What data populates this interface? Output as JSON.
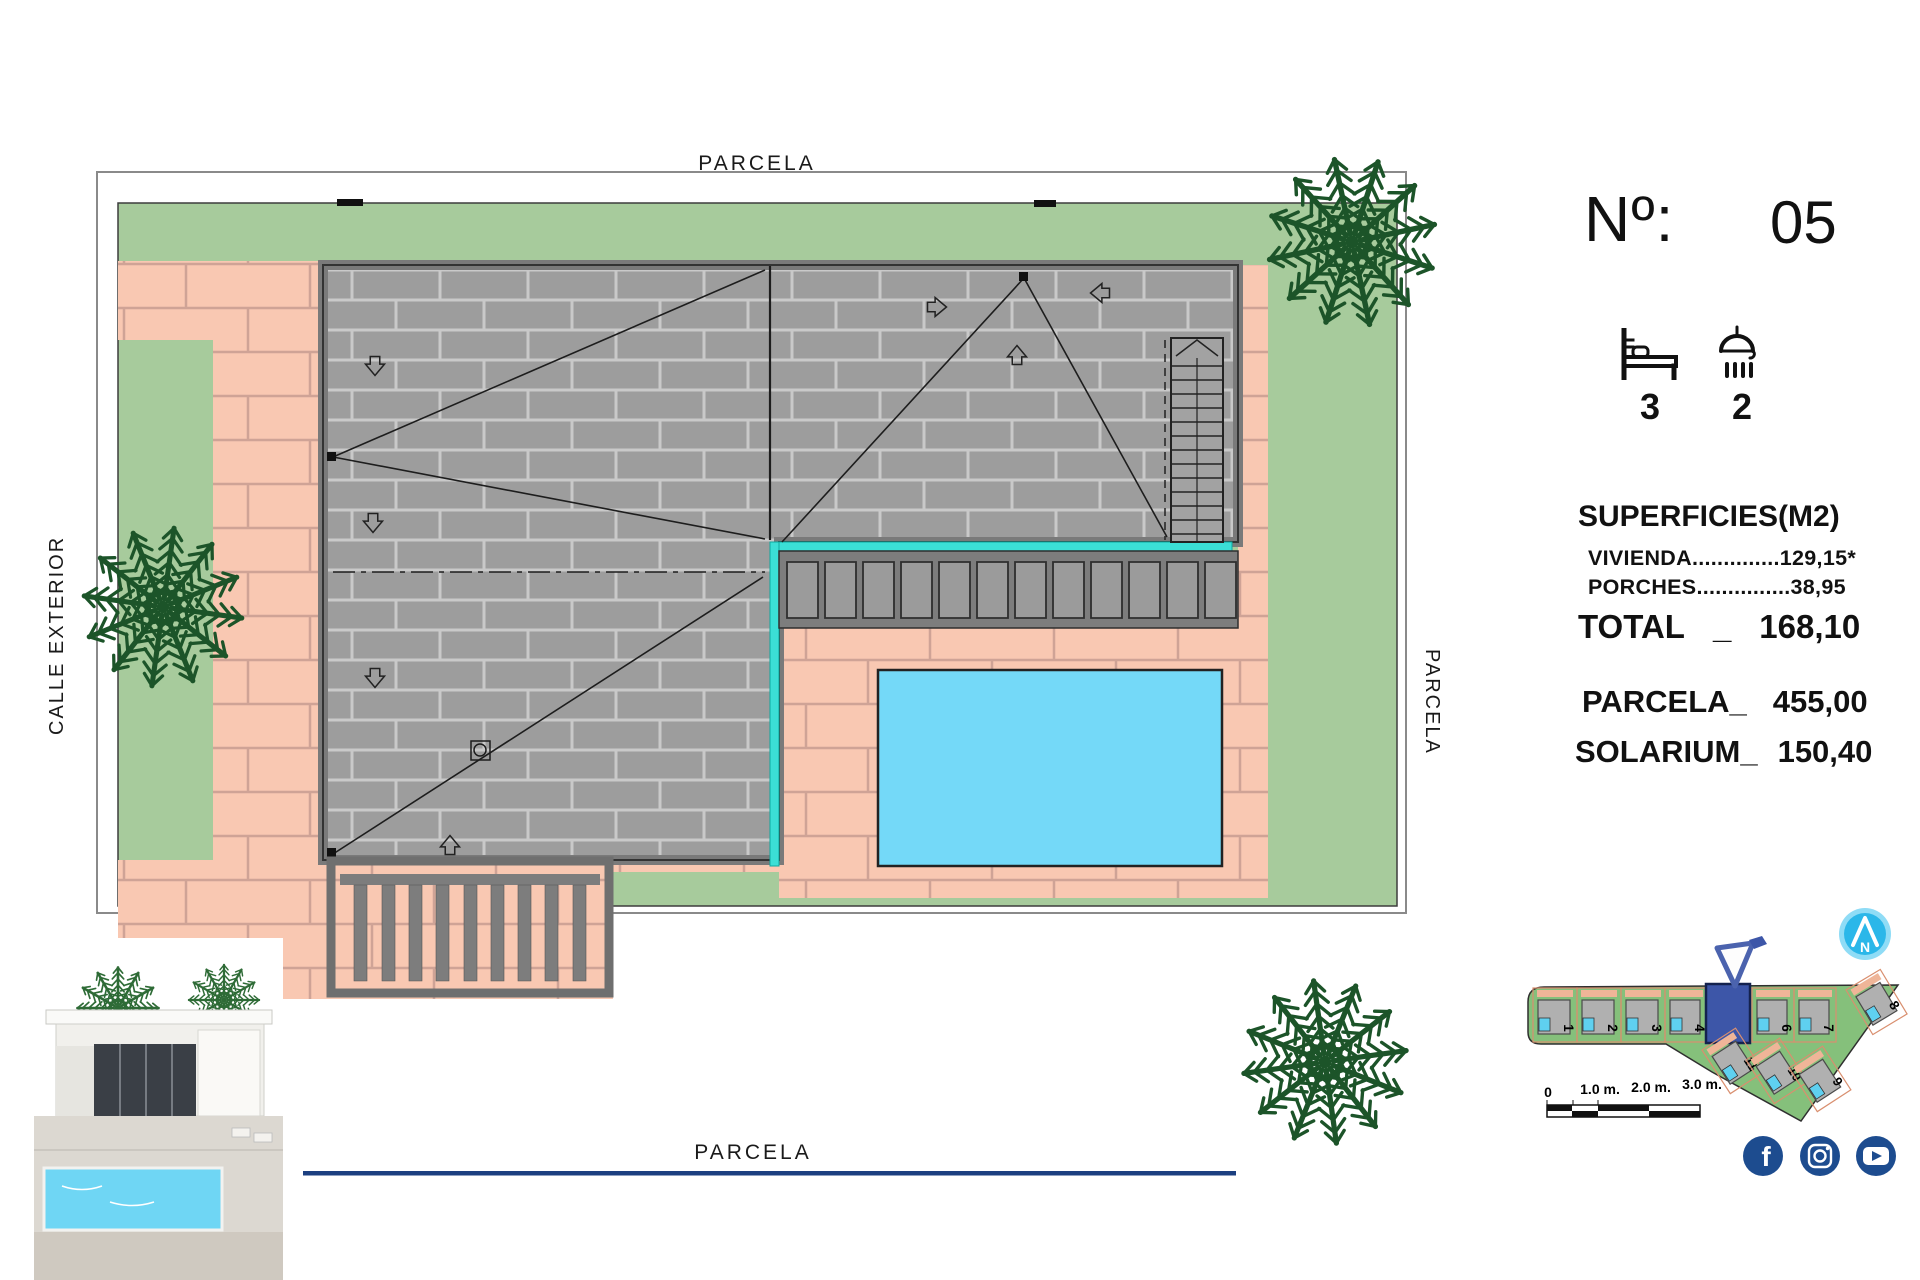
{
  "plan": {
    "labels": {
      "top": "PARCELA",
      "bottom": "PARCELA",
      "right": "PARCELA",
      "left": "CALLE EXTERIOR"
    }
  },
  "info_panel": {
    "number_label": "Nº:",
    "number_value": "05",
    "bedrooms": "3",
    "bathrooms": "2",
    "surfaces_title": "SUPERFICIES(M2)",
    "surface_lines": [
      {
        "label": "VIVIENDA",
        "dots": "..............",
        "value": "129,15*"
      },
      {
        "label": "PORCHES",
        "dots": "...............",
        "value": "38,95"
      }
    ],
    "total": {
      "label": "TOTAL",
      "separator": "_",
      "value": "168,10"
    },
    "parcela": {
      "label": "PARCELA_",
      "value": "455,00"
    },
    "solarium": {
      "label": "SOLARIUM_",
      "value": "150,40"
    }
  },
  "minimap": {
    "compass_letter": "N",
    "plot_numbers": [
      "1",
      "2",
      "3",
      "4",
      "6",
      "7",
      "8",
      "11",
      "10",
      "9"
    ],
    "scale_labels": [
      "0",
      "1.0 m.",
      "2.0 m.",
      "3.0 m."
    ]
  },
  "social": {
    "facebook_glyph": "f"
  },
  "colors": {
    "grass": "#A7CB9C",
    "paving": "#F9C8B2",
    "roof": "#9D9D9D",
    "pool": "#74D9F8",
    "solarium_edge": "#3BDFD6",
    "navy": "#1D4C8F",
    "compass_blue": "#2BB7E9",
    "palm": "#1C5429",
    "minimap_grass": "#85C07B",
    "highlight_plot": "#3D56A8"
  }
}
